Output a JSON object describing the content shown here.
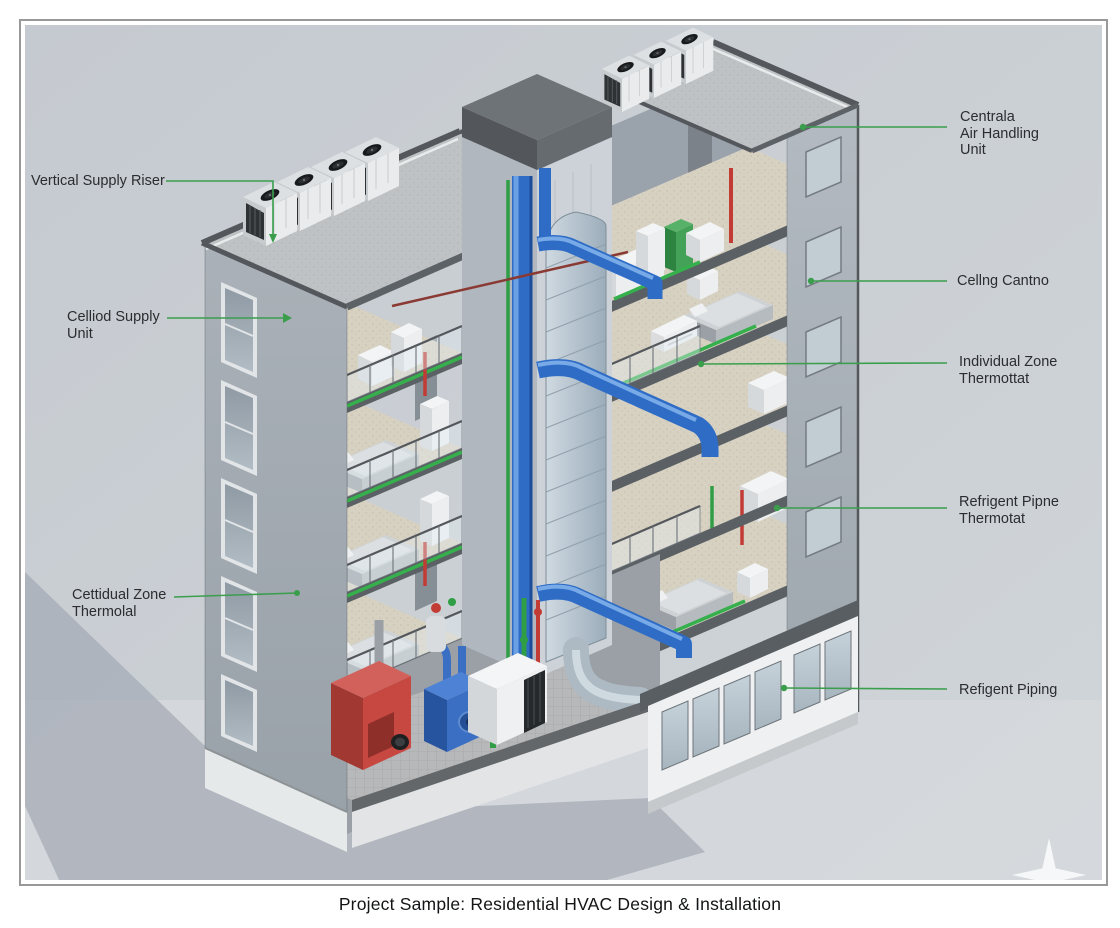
{
  "frame": {
    "background": "#c9ced3",
    "border_color": "#97999b"
  },
  "caption": "Project Sample: Residential HVAC Design & Installation",
  "labels": [
    {
      "id": "vertical-supply-riser",
      "lines": [
        "Vertical Supply Riser"
      ]
    },
    {
      "id": "ceiling-supply-unit",
      "lines": [
        "Celliod Supply",
        "Unit"
      ]
    },
    {
      "id": "zone-thermostat-left",
      "lines": [
        "Cettidual Zone",
        "Thermolal"
      ]
    },
    {
      "id": "central-air-handling-unit",
      "lines": [
        "Centrala",
        "Air Handling",
        "Unit"
      ]
    },
    {
      "id": "ceiling-cassette",
      "lines": [
        "Cellng Cantno"
      ]
    },
    {
      "id": "individual-zone-thermostat",
      "lines": [
        "Individual Zone",
        "Thermottat"
      ]
    },
    {
      "id": "refrigerant-pipe-thermostat",
      "lines": [
        "Refrigent Pipne",
        "Thermotat"
      ]
    },
    {
      "id": "refrigerant-piping",
      "lines": [
        "Refigent Piping"
      ]
    }
  ],
  "colors": {
    "leader_green": "#3a9e4d",
    "pipe_green": "#2f9e44",
    "pipe_red": "#c23b35",
    "duct_blue": "#2e6cc6",
    "boiler_red": "#c64840",
    "wall_grey": "#a0a8b1",
    "floor_beige": "#d7d1c2"
  },
  "watermark": {
    "shape": "four-point-star"
  }
}
